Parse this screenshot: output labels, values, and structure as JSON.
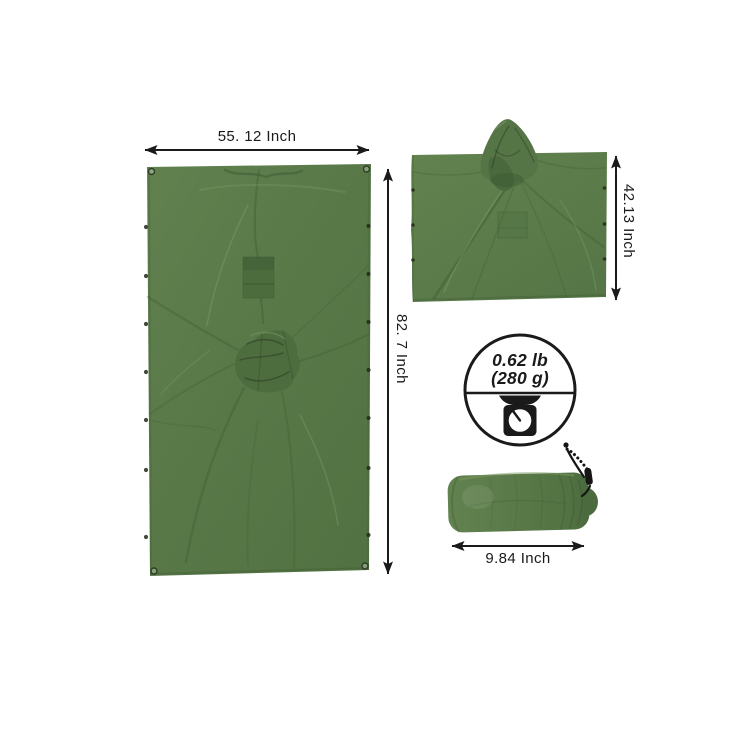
{
  "page": {
    "background": "#ffffff",
    "kind": "product dimension diagram"
  },
  "colors": {
    "paper": "#ffffff",
    "ink": "#1a1a1a",
    "green_base": "#5a7a49",
    "green_light": "#7b9a63",
    "green_dark": "#4b6a3d",
    "green_deep": "#3a5730",
    "green_shadow": "#2b3a20"
  },
  "labels": {
    "tarp_width": "55. 12 Inch",
    "tarp_height": "82. 7 Inch",
    "poncho_height": "42.13 Inch",
    "sack_width": "9.84 Inch"
  },
  "weight_badge": {
    "pounds": "0.62 lb",
    "grams": "(280 g)",
    "icon": "kitchen-scale-icon"
  }
}
